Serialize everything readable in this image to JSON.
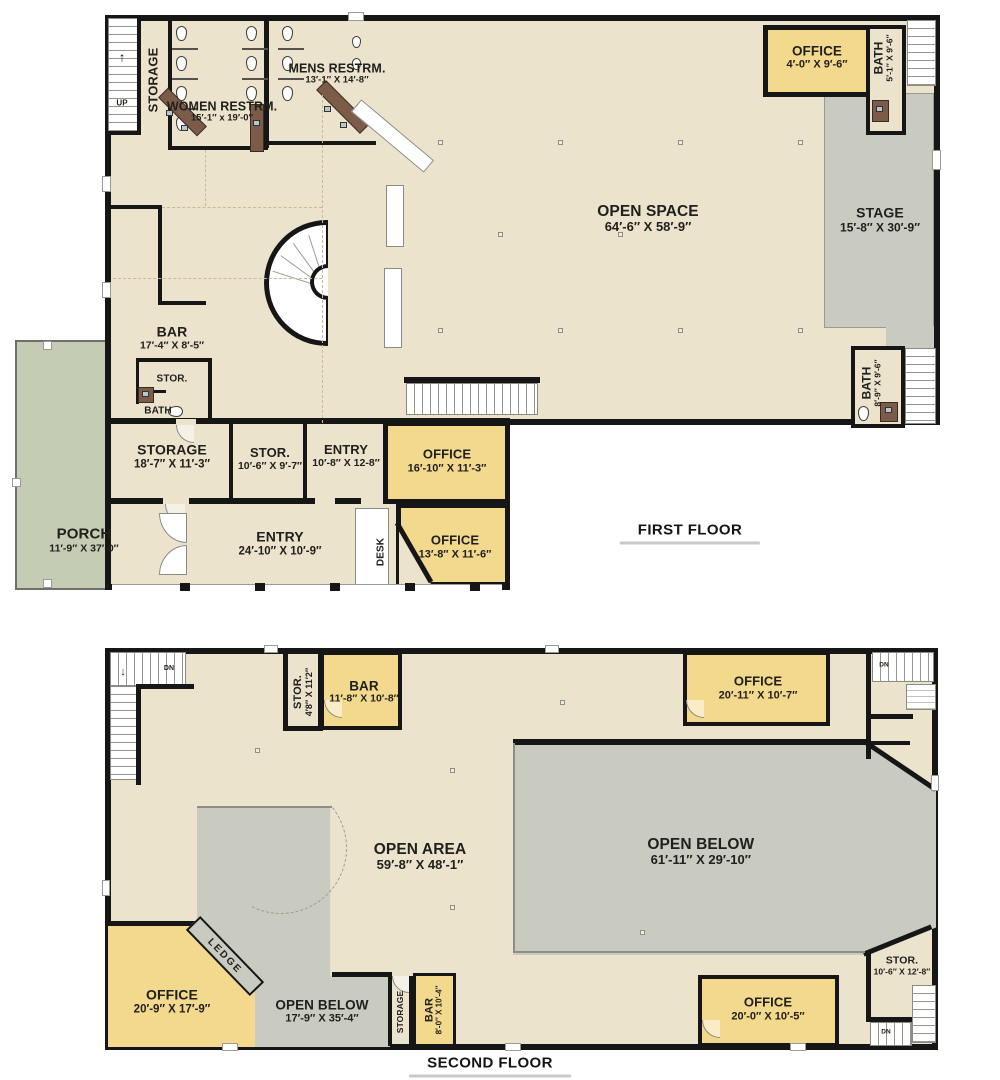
{
  "colors": {
    "floor_beige": "#ece3cd",
    "room_yellow": "#f3d98d",
    "overlook_gray": "#c9cac0",
    "porch_green": "#c5ccb4",
    "counter_brown": "#7d5b49",
    "wall_black": "#161616",
    "stair_white": "#ffffff"
  },
  "icons": {
    "up_arrow": "↑",
    "down_arrow": "↓"
  },
  "first_floor": {
    "title": "FIRST FLOOR",
    "stairs": {
      "up_label": "UP"
    },
    "rooms": {
      "storage_top": {
        "name": "STORAGE"
      },
      "women_restroom": {
        "name": "WOMEN RESTRM.",
        "dims": "15′-1″ x 19′-0″"
      },
      "mens_restroom": {
        "name": "MENS RESTRM.",
        "dims": "13′-1″ X 14′-8″"
      },
      "office_top_right": {
        "name": "OFFICE",
        "dims": "4′-0″ X 9′-6″"
      },
      "bath_top_right": {
        "name": "BATH",
        "dims": "5′-1″ X 9′-6″"
      },
      "open_space": {
        "name": "OPEN SPACE",
        "dims": "64′-6″ X 58′-9″"
      },
      "stage": {
        "name": "STAGE",
        "dims": "15′-8″ X 30′-9″"
      },
      "bath_bottom_right": {
        "name": "BATH",
        "dims": "8′-9″ X 9′-6″"
      },
      "bar": {
        "name": "BAR",
        "dims": "17′-4″ X 8′-5″"
      },
      "stor_by_bar": {
        "name": "STOR."
      },
      "bath_by_bar": {
        "name": "BATH"
      },
      "storage_left": {
        "name": "STORAGE",
        "dims": "18′-7″ X 11′-3″"
      },
      "stor_center": {
        "name": "STOR.",
        "dims": "10′-6″ X 9′-7″"
      },
      "entry_small": {
        "name": "ENTRY",
        "dims": "10′-8″ X 12-8″"
      },
      "office_16": {
        "name": "OFFICE",
        "dims": "16′-10″ X 11′-3″"
      },
      "office_13": {
        "name": "OFFICE",
        "dims": "13′-8″ X 11′-6″"
      },
      "desk": {
        "name": "DESK"
      },
      "porch": {
        "name": "PORCH",
        "dims": "11′-9″ X 37′-0″"
      },
      "entry_main": {
        "name": "ENTRY",
        "dims": "24′-10″ X 10′-9″"
      }
    }
  },
  "second_floor": {
    "title": "SECOND FLOOR",
    "stairs": {
      "dn_top_left": "DN",
      "dn_top_right": "DN",
      "dn_bottom_right": "DN"
    },
    "rooms": {
      "stor_top": {
        "name": "STOR.",
        "dims": "4′8″ X 11′2″"
      },
      "bar_top": {
        "name": "BAR",
        "dims": "11′-8″ X 10′-8″"
      },
      "office_top_right": {
        "name": "OFFICE",
        "dims": "20′-11″ X 10′-7″"
      },
      "open_area": {
        "name": "OPEN AREA",
        "dims": "59′-8″ X 48′-1″"
      },
      "open_below_right": {
        "name": "OPEN BELOW",
        "dims": "61′-11″ X 29′-10″"
      },
      "office_bottom_left": {
        "name": "OFFICE",
        "dims": "20′-9″ X 17′-9″"
      },
      "ledge": {
        "name": "LEDGE"
      },
      "open_below_center": {
        "name": "OPEN BELOW",
        "dims": "17′-9″ X 35′-4″"
      },
      "storage_bottom": {
        "name": "STORAGE"
      },
      "bar_bottom": {
        "name": "BAR",
        "dims": "8′-0″ X 10′-4″"
      },
      "office_bottom_right": {
        "name": "OFFICE",
        "dims": "20′-0″ X 10′-5″"
      },
      "stor_bottom_right": {
        "name": "STOR.",
        "dims": "10′-6″ X 12′-8″"
      }
    }
  }
}
